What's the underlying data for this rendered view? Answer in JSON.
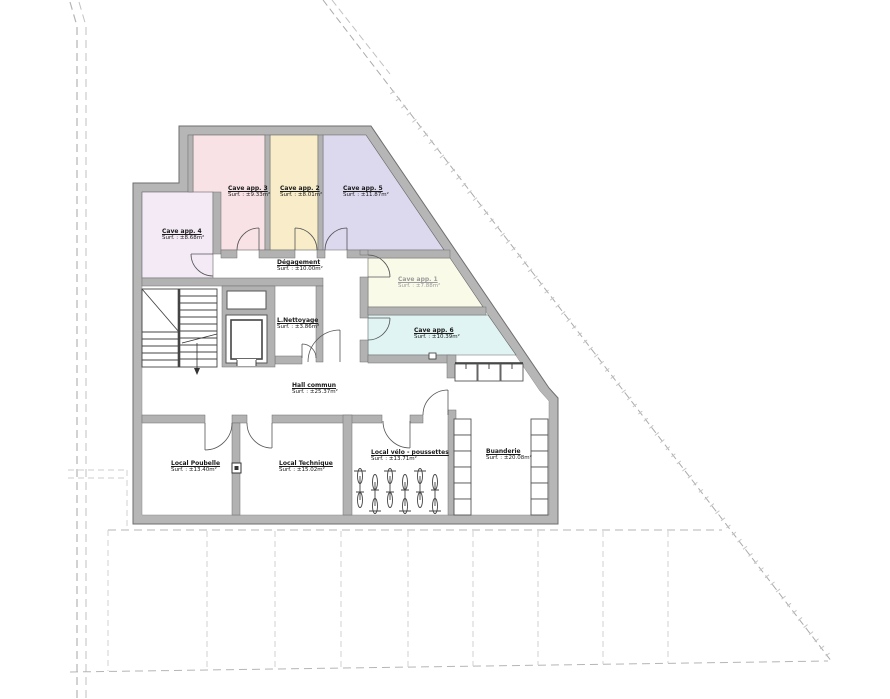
{
  "plan": {
    "kind": "basement floor plan",
    "language": "fr"
  },
  "rooms": [
    {
      "id": "cave-app-3",
      "name": "Cave app. 3",
      "area": "Surf. : ±9.33m²",
      "color": "#f8e2e6"
    },
    {
      "id": "cave-app-2",
      "name": "Cave app. 2",
      "area": "Surf. : ±8.01m²",
      "color": "#f8edc8"
    },
    {
      "id": "cave-app-5",
      "name": "Cave app. 5",
      "area": "Surf. : ±11.87m²",
      "color": "#dcd9ef"
    },
    {
      "id": "cave-app-4",
      "name": "Cave app. 4",
      "area": "Surf. : ±8.68m²",
      "color": "#f3eaf6"
    },
    {
      "id": "degagement",
      "name": "Dégagement",
      "area": "Surf. : ±10.00m²",
      "color": "#ffffff"
    },
    {
      "id": "cave-app-1",
      "name": "Cave app. 1",
      "area": "Surf. : ±7.88m²",
      "color": "#fafae9"
    },
    {
      "id": "l-nettoyage",
      "name": "L.Nettoyage",
      "area": "Surf. : ±3.86m²",
      "color": "#ffffff"
    },
    {
      "id": "cave-app-6",
      "name": "Cave app. 6",
      "area": "Surf. : ±10.39m²",
      "color": "#e1f4f4"
    },
    {
      "id": "hall-commun",
      "name": "Hall commun",
      "area": "Surf. : ±25.37m²",
      "color": "#ffffff"
    },
    {
      "id": "local-poubelle",
      "name": "Local Poubelle",
      "area": "Surf. : ±13.40m²",
      "color": "#ffffff"
    },
    {
      "id": "local-technique",
      "name": "Local Technique",
      "area": "Surf. : ±15.02m²",
      "color": "#ffffff"
    },
    {
      "id": "local-velo",
      "name": "Local vélo - poussettes",
      "area": "Surf. : ±13.71m²",
      "color": "#ffffff"
    },
    {
      "id": "buanderie",
      "name": "Buanderie",
      "area": "Surf. : ±20.08m²",
      "color": "#ffffff"
    }
  ],
  "colors": {
    "wall_fill": "#b6b6b6",
    "wall_edge": "#6e6e6e",
    "interior_fill": "#ffffff",
    "boundary_line": "#b2b2b2",
    "parking_line": "#cccccc",
    "detail_line": "#4a4a4a"
  }
}
